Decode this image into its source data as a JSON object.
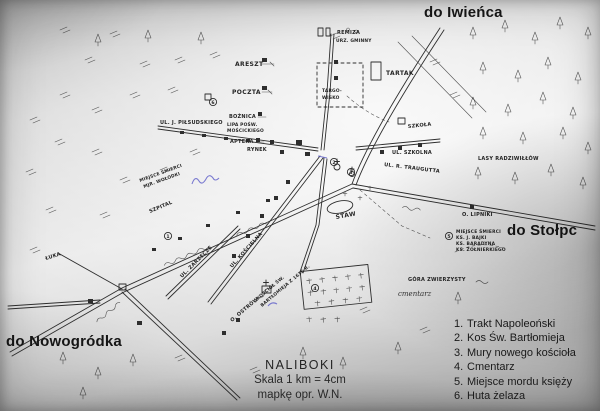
{
  "scan": {
    "paper_light": "#ebebeb",
    "paper_dark": "#989898",
    "ink": "#2e2e2e",
    "print_ink": "#161616",
    "blue_ink": "#5d5dc8"
  },
  "directions": {
    "iwienca": "do Iwieńca",
    "stolpc": "do Stołpc",
    "nowogrodka": "do Nowogródka"
  },
  "title": {
    "name": "NALIBOKI",
    "scale": "Skala 1 km = 4cm",
    "credit": "mapkę opr. W.N."
  },
  "legend": {
    "rows": [
      {
        "num": "1.",
        "text": "Trakt Napoleoński"
      },
      {
        "num": "2.",
        "text": "Kos Św. Bartłomieja"
      },
      {
        "num": "3.",
        "text": "Mury nowego kościoła"
      },
      {
        "num": "4.",
        "text": "Cmentarz"
      },
      {
        "num": "5.",
        "text": "Miejsce mordu księży"
      },
      {
        "num": "6.",
        "text": "Huta żelaza"
      }
    ]
  },
  "map_labels": {
    "areszt": "ARESZT",
    "poczta": "POCZTA",
    "boznica": "BOŻNICA",
    "lipa_line1": "LIPA POŚW.",
    "lipa_line2": "MOŚCICKIEGO",
    "apteka": "APTEKA",
    "rynek": "RYNEK",
    "pilsudskiego": "UL. J. PIŁSUDSKIEGO",
    "remiza": "REMIZA",
    "urzad_gminny": "URZ. GMINNY",
    "targowisko_line1": "TARGO-",
    "targowisko_line2": "WISKO",
    "tartak": "TARTAK",
    "szkola": "SZKOŁA",
    "ul_szkolna": "UL. SZKOLNA",
    "ul_traugutta": "UL. R. TRAUGUTTA",
    "lasy_radziwillow": "LASY RADZIWIŁŁÓW",
    "lipniki": "O. LIPNIKI",
    "miejsce_smierci_line1": "MIEJSCE ŚMIERCI",
    "miejsce_smierci_line2": "KS. J. BAJKI",
    "miejsce_smierci_line3": "KS. BARADYNA",
    "miejsce_smierci_line4": "KS. ŻOŁNIERKIEGO",
    "gora": "GÓRA ZWIERZYSTY",
    "cmentarz_hand": "cmentarz",
    "staw": "STAW",
    "ul_koscielna": "UL. KOŚCIELNA",
    "ul_zarzecze": "UL. ZARZECZE",
    "ostrow": "O. OSTRÓW",
    "kosciol_line1": "KOŚCIÓŁ ŚW.",
    "kosciol_line2": "BARTŁOMIEJA Z 1636 R.",
    "szpital": "SZPITAL",
    "wolodki_line1": "MIEJSCE ŚMIERCI",
    "wolodki_line2": "MJR. WOŁODKI",
    "luka": "ŁUKA"
  },
  "markers": {
    "m1": "1",
    "m2": "2",
    "m3": "3",
    "m4": "4",
    "m5": "5",
    "m6": "6"
  }
}
